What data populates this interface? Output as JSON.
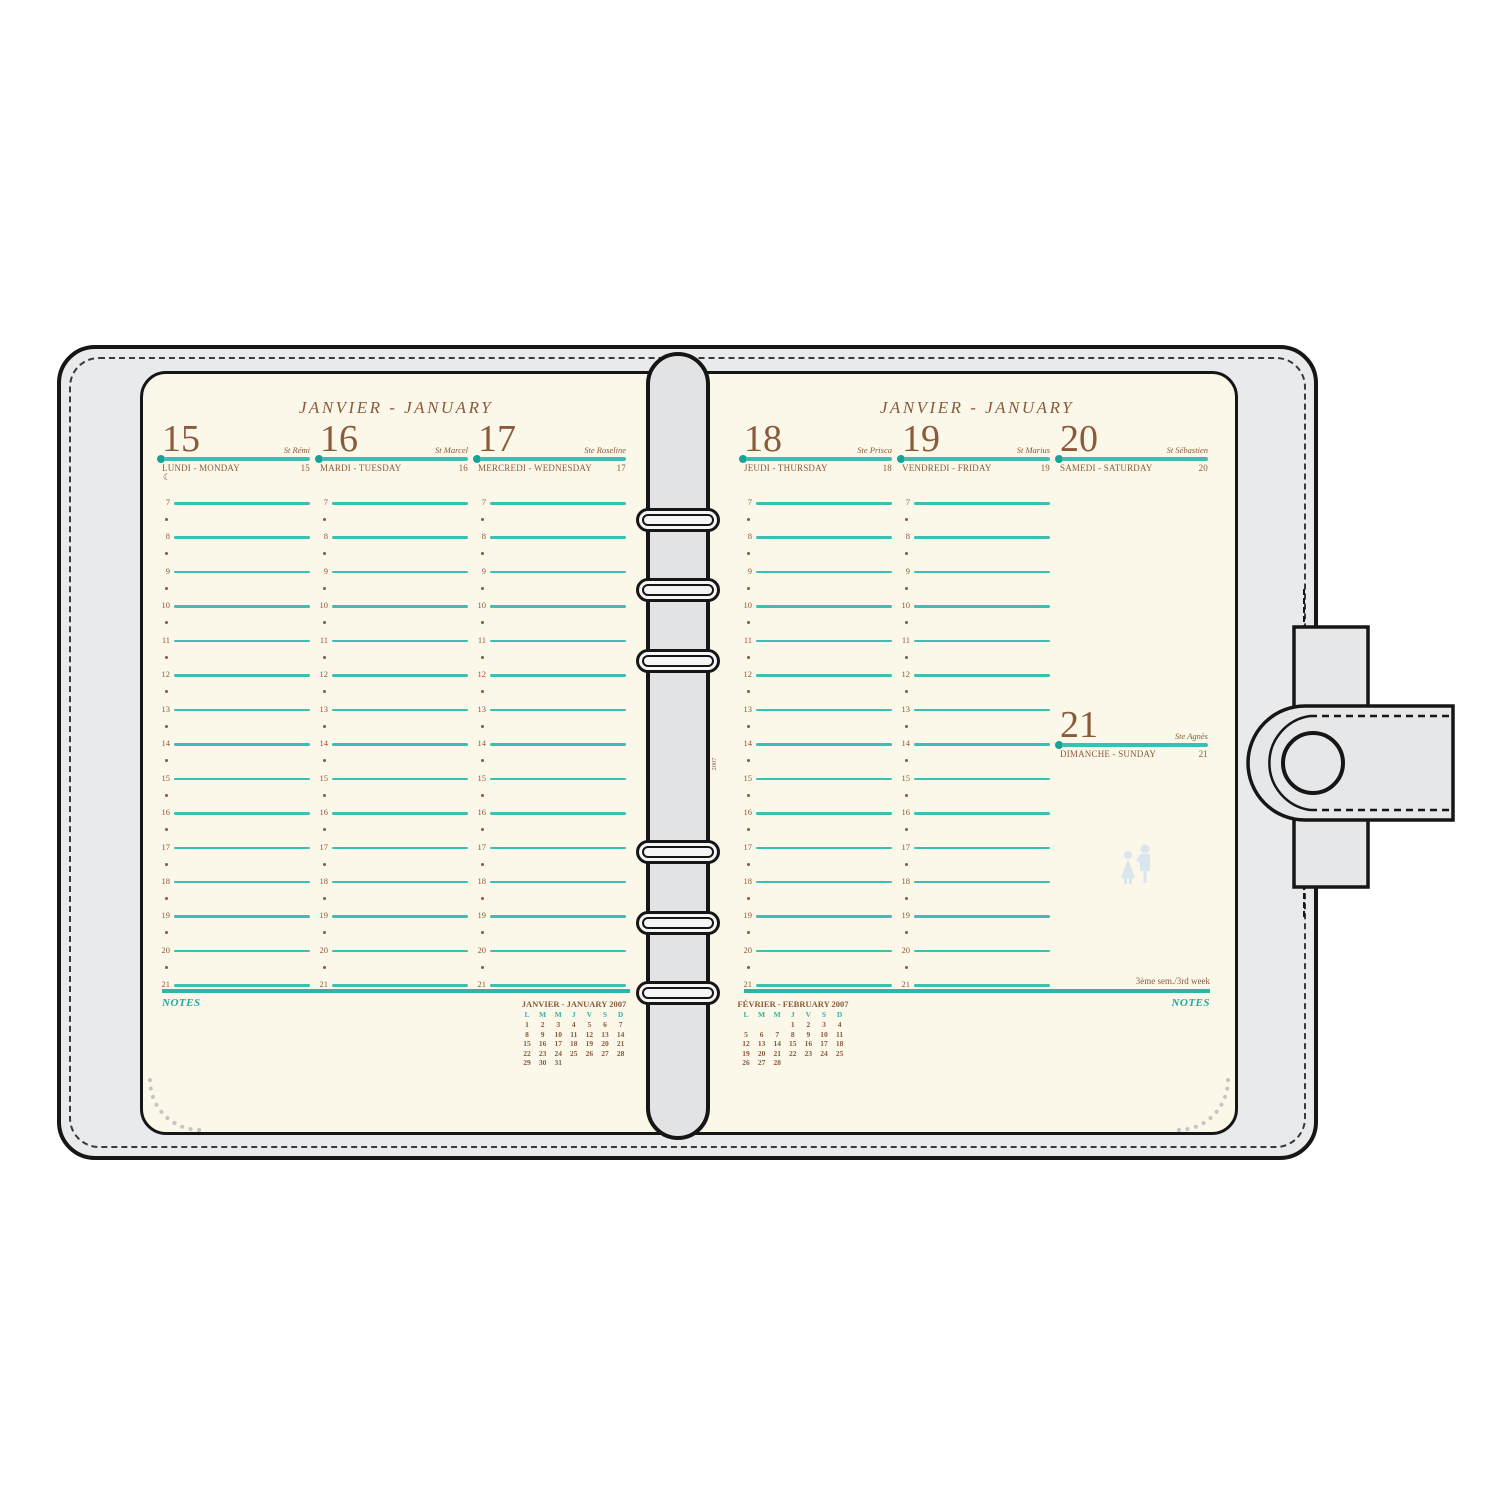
{
  "pages": {
    "left": {
      "title": "JANVIER - JANUARY"
    },
    "right": {
      "title": "JANVIER - JANUARY"
    }
  },
  "week": {
    "week_label": "3ème sem./3rd week",
    "notes_label": "NOTES",
    "half_hour_marker": "•",
    "hours": [
      "7",
      "8",
      "9",
      "10",
      "11",
      "12",
      "13",
      "14",
      "15",
      "16",
      "17",
      "18",
      "19",
      "20",
      "21"
    ],
    "days": [
      {
        "date_number": "15",
        "label": "LUNDI - MONDAY",
        "saint": "St Rémi",
        "small_number": "15",
        "moon_icon": true
      },
      {
        "date_number": "16",
        "label": "MARDI - TUESDAY",
        "saint": "St Marcel",
        "small_number": "16"
      },
      {
        "date_number": "17",
        "label": "MERCREDI - WEDNESDAY",
        "saint": "Ste Roseline",
        "small_number": "17"
      },
      {
        "date_number": "18",
        "label": "JEUDI - THURSDAY",
        "saint": "Ste Prisca",
        "small_number": "18"
      },
      {
        "date_number": "19",
        "label": "VENDREDI - FRIDAY",
        "saint": "St Marius",
        "small_number": "19"
      },
      {
        "date_number": "20",
        "label": "SAMEDI - SATURDAY",
        "saint": "St Sébastien",
        "small_number": "20"
      },
      {
        "date_number": "21",
        "label": "DIMANCHE - SUNDAY",
        "saint": "Ste Agnès",
        "small_number": "21"
      }
    ]
  },
  "mini_calendars": [
    {
      "title": "JANVIER - JANUARY 2007",
      "dow": [
        "L",
        "M",
        "M",
        "J",
        "V",
        "S",
        "D"
      ],
      "rows": [
        [
          "1",
          "2",
          "3",
          "4",
          "5",
          "6",
          "7"
        ],
        [
          "8",
          "9",
          "10",
          "11",
          "12",
          "13",
          "14"
        ],
        [
          "15",
          "16",
          "17",
          "18",
          "19",
          "20",
          "21"
        ],
        [
          "22",
          "23",
          "24",
          "25",
          "26",
          "27",
          "28"
        ],
        [
          "29",
          "30",
          "31",
          "",
          "",
          "",
          ""
        ]
      ]
    },
    {
      "title": "FÉVRIER - FEBRUARY 2007",
      "dow": [
        "L",
        "M",
        "M",
        "J",
        "V",
        "S",
        "D"
      ],
      "rows": [
        [
          "",
          "",
          "",
          "1",
          "2",
          "3",
          "4"
        ],
        [
          "5",
          "6",
          "7",
          "8",
          "9",
          "10",
          "11"
        ],
        [
          "12",
          "13",
          "14",
          "15",
          "16",
          "17",
          "18"
        ],
        [
          "19",
          "20",
          "21",
          "22",
          "23",
          "24",
          "25"
        ],
        [
          "26",
          "27",
          "28",
          "",
          "",
          "",
          ""
        ]
      ]
    }
  ],
  "spine_ref": {
    "line1": "MIDI 30",
    "line2": "2007"
  },
  "icons": {
    "moon_glyph": "☾",
    "watermark": "couple-figures-watermark",
    "rings": "binder-ring",
    "snap": "snap-button"
  },
  "colors": {
    "teal_line": "#3BBFB2",
    "teal_dark": "#17A396",
    "brown_text": "#8A5A3A",
    "page_cream": "#FBF8E9",
    "cover_gray": "#E9EAEC",
    "spine_gray": "#E2E3E5",
    "watermark_blue": "#D9E6EE"
  }
}
